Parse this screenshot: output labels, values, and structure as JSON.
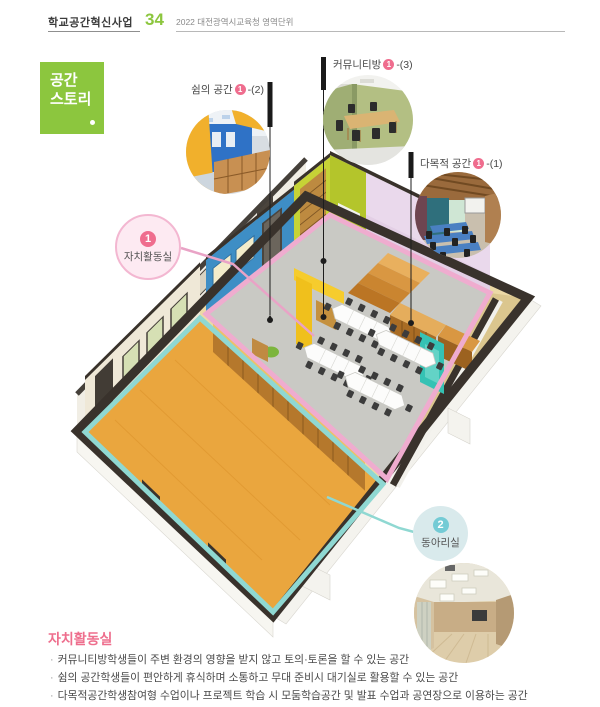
{
  "header": {
    "program": "학교공간혁신사업",
    "page_number": "34",
    "subtitle": "2022 대전광역시교육청 영역단위"
  },
  "story_box": {
    "line1": "공간",
    "line2": "스토리"
  },
  "callouts": {
    "rest": {
      "label": "쉼의 공간",
      "number": "1",
      "suffix": "-(2)"
    },
    "community": {
      "label": "커뮤니티방",
      "number": "1",
      "suffix": "-(3)"
    },
    "multipurpose": {
      "label": "다목적 공간",
      "number": "1",
      "suffix": "-(1)"
    }
  },
  "badges": {
    "jachi": {
      "number": "1",
      "label": "자치활동실"
    },
    "dongari": {
      "number": "2",
      "label": "동아리실"
    }
  },
  "description": {
    "title": "자치활동실",
    "bullet_char": "·",
    "bullets": [
      "커뮤니티방학생들이 주변 환경의 영향을 받지 않고 토의·토론을  할 수 있는 공간",
      "쉼의 공간학생들이 편안하게 휴식하며 소통하고 무대 준비시 대기실로 활용할 수 있는 공간",
      "다목적공간학생참여형 수업이나 프로젝트 학습 시 모둠학습공간 및 발표 수업과 공연장으로 이용하는 공간"
    ]
  },
  "colors": {
    "brand_green": "#8cc63e",
    "accent_pink": "#ef6d8e",
    "room1_outline_pink": "#efaccf",
    "room2_outline_cyan": "#8fd8d2",
    "heading_coral": "#ee6e8d"
  }
}
